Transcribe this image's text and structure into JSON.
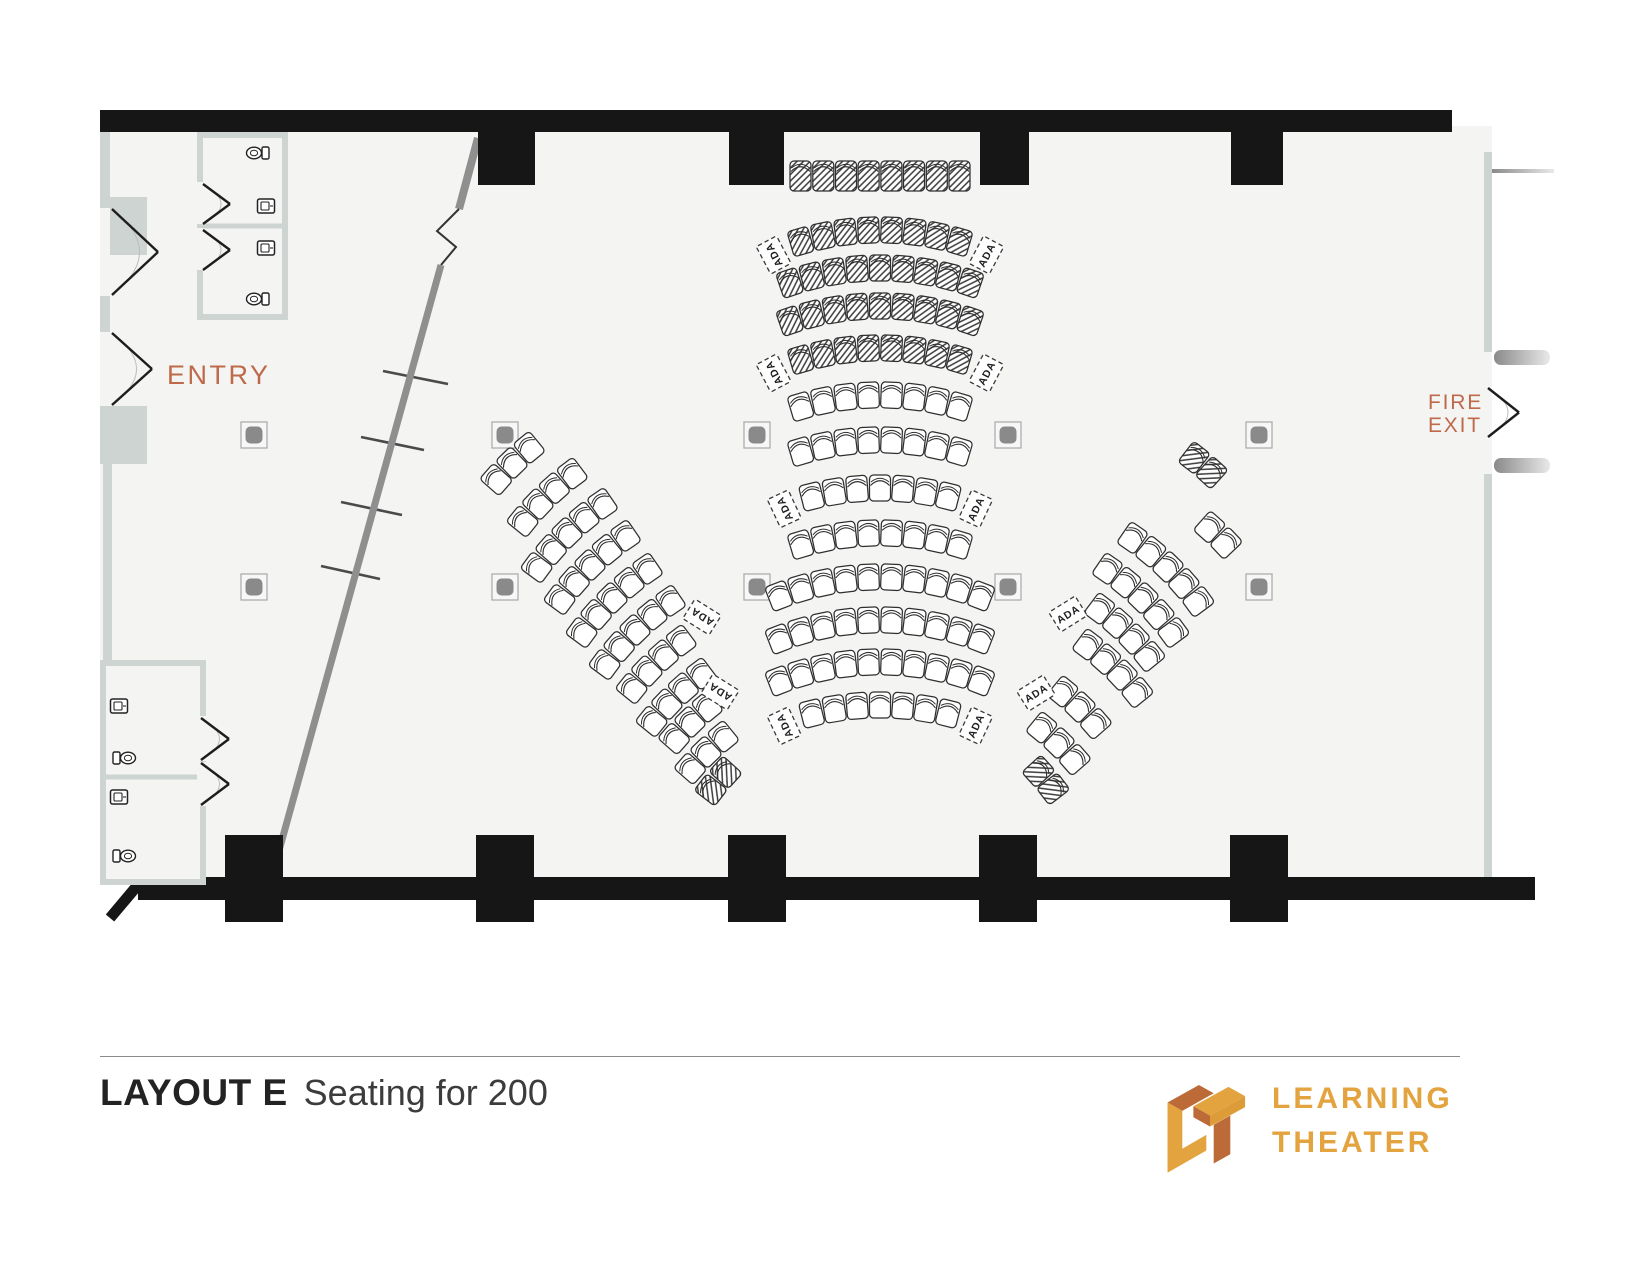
{
  "page_title": {
    "name": "LAYOUT E",
    "subtitle": "Seating for 200"
  },
  "labels": {
    "entry": "ENTRY",
    "fire": "FIRE",
    "exit": "EXIT",
    "ada": "ADA"
  },
  "logo": {
    "line1": "LEARNING",
    "line2": "THEATER"
  },
  "colors": {
    "accent_text": "#BE6A4A",
    "logo_gold": "#E3A33F",
    "logo_rust": "#BC6A37",
    "wall_black": "#161616",
    "wall_gray": "#cdd4d1",
    "diag_gray": "#8f8f8f",
    "floor": "#f4f4f2",
    "seat_stroke": "#2f2f2f",
    "floor_box": "#8a8a8a"
  },
  "seating": {
    "capacity_label": "Seating for 200",
    "front_row": {
      "y": 176,
      "seats": 8,
      "hatched": true
    },
    "center": {
      "cx": 880,
      "rows": [
        {
          "y": 230,
          "seats": 8,
          "hatched": true,
          "ada": true
        },
        {
          "y": 268,
          "seats": 9,
          "hatched": true,
          "ada": false
        },
        {
          "y": 306,
          "seats": 9,
          "hatched": true,
          "ada": false
        },
        {
          "y": 348,
          "seats": 8,
          "hatched": true,
          "ada": true
        },
        {
          "y": 395,
          "seats": 8,
          "hatched": false,
          "ada": false
        },
        {
          "y": 440,
          "seats": 8,
          "hatched": false,
          "ada": false
        },
        {
          "y": 488,
          "seats": 7,
          "hatched": false,
          "ada": true
        },
        {
          "y": 533,
          "seats": 8,
          "hatched": false,
          "ada": false
        },
        {
          "y": 577,
          "seats": 10,
          "hatched": false,
          "ada": false
        },
        {
          "y": 620,
          "seats": 10,
          "hatched": false,
          "ada": false
        },
        {
          "y": 662,
          "seats": 10,
          "hatched": false,
          "ada": false
        },
        {
          "y": 705,
          "seats": 7,
          "hatched": false,
          "ada": true
        }
      ]
    },
    "left_wing": {
      "rot": -44,
      "rows": [
        {
          "x": 512,
          "y": 463,
          "seats": 3
        },
        {
          "x": 546,
          "y": 496,
          "seats": 4
        },
        {
          "x": 567,
          "y": 533,
          "seats": 5
        },
        {
          "x": 590,
          "y": 565,
          "seats": 5
        },
        {
          "x": 612,
          "y": 598,
          "seats": 5
        },
        {
          "x": 635,
          "y": 630,
          "seats": 5
        },
        {
          "x": 655,
          "y": 663,
          "seats": 4
        },
        {
          "x": 675,
          "y": 696,
          "seats": 4
        },
        {
          "x": 690,
          "y": 722,
          "seats": 3
        },
        {
          "x": 706,
          "y": 752,
          "seats": 3
        },
        {
          "x": 718,
          "y": 781,
          "seats": 2,
          "hatched": true,
          "rot": -50
        }
      ],
      "ada_tags": [
        {
          "x": 702,
          "y": 617,
          "rot": -58
        },
        {
          "x": 720,
          "y": 692,
          "rot": -58
        }
      ]
    },
    "right_wing": {
      "rot": 44,
      "rows": [
        {
          "x": 1203,
          "y": 465,
          "seats": 2,
          "hatched": true,
          "rot": 40
        },
        {
          "x": 1218,
          "y": 535,
          "seats": 2
        },
        {
          "x": 1168,
          "y": 567,
          "seats": 5
        },
        {
          "x": 1143,
          "y": 598,
          "seats": 5
        },
        {
          "x": 1126,
          "y": 631,
          "seats": 4
        },
        {
          "x": 1114,
          "y": 667,
          "seats": 4
        },
        {
          "x": 1080,
          "y": 707,
          "seats": 3
        },
        {
          "x": 1059,
          "y": 743,
          "seats": 3
        },
        {
          "x": 1046,
          "y": 780,
          "seats": 2,
          "hatched": true,
          "rot": 50
        }
      ],
      "ada_tags": [
        {
          "x": 1068,
          "y": 614,
          "rot": 58
        },
        {
          "x": 1036,
          "y": 693,
          "rot": 58
        }
      ]
    }
  },
  "floor_boxes": {
    "xs": [
      254,
      505,
      757,
      1008,
      1259
    ],
    "ys": [
      435,
      587
    ]
  }
}
